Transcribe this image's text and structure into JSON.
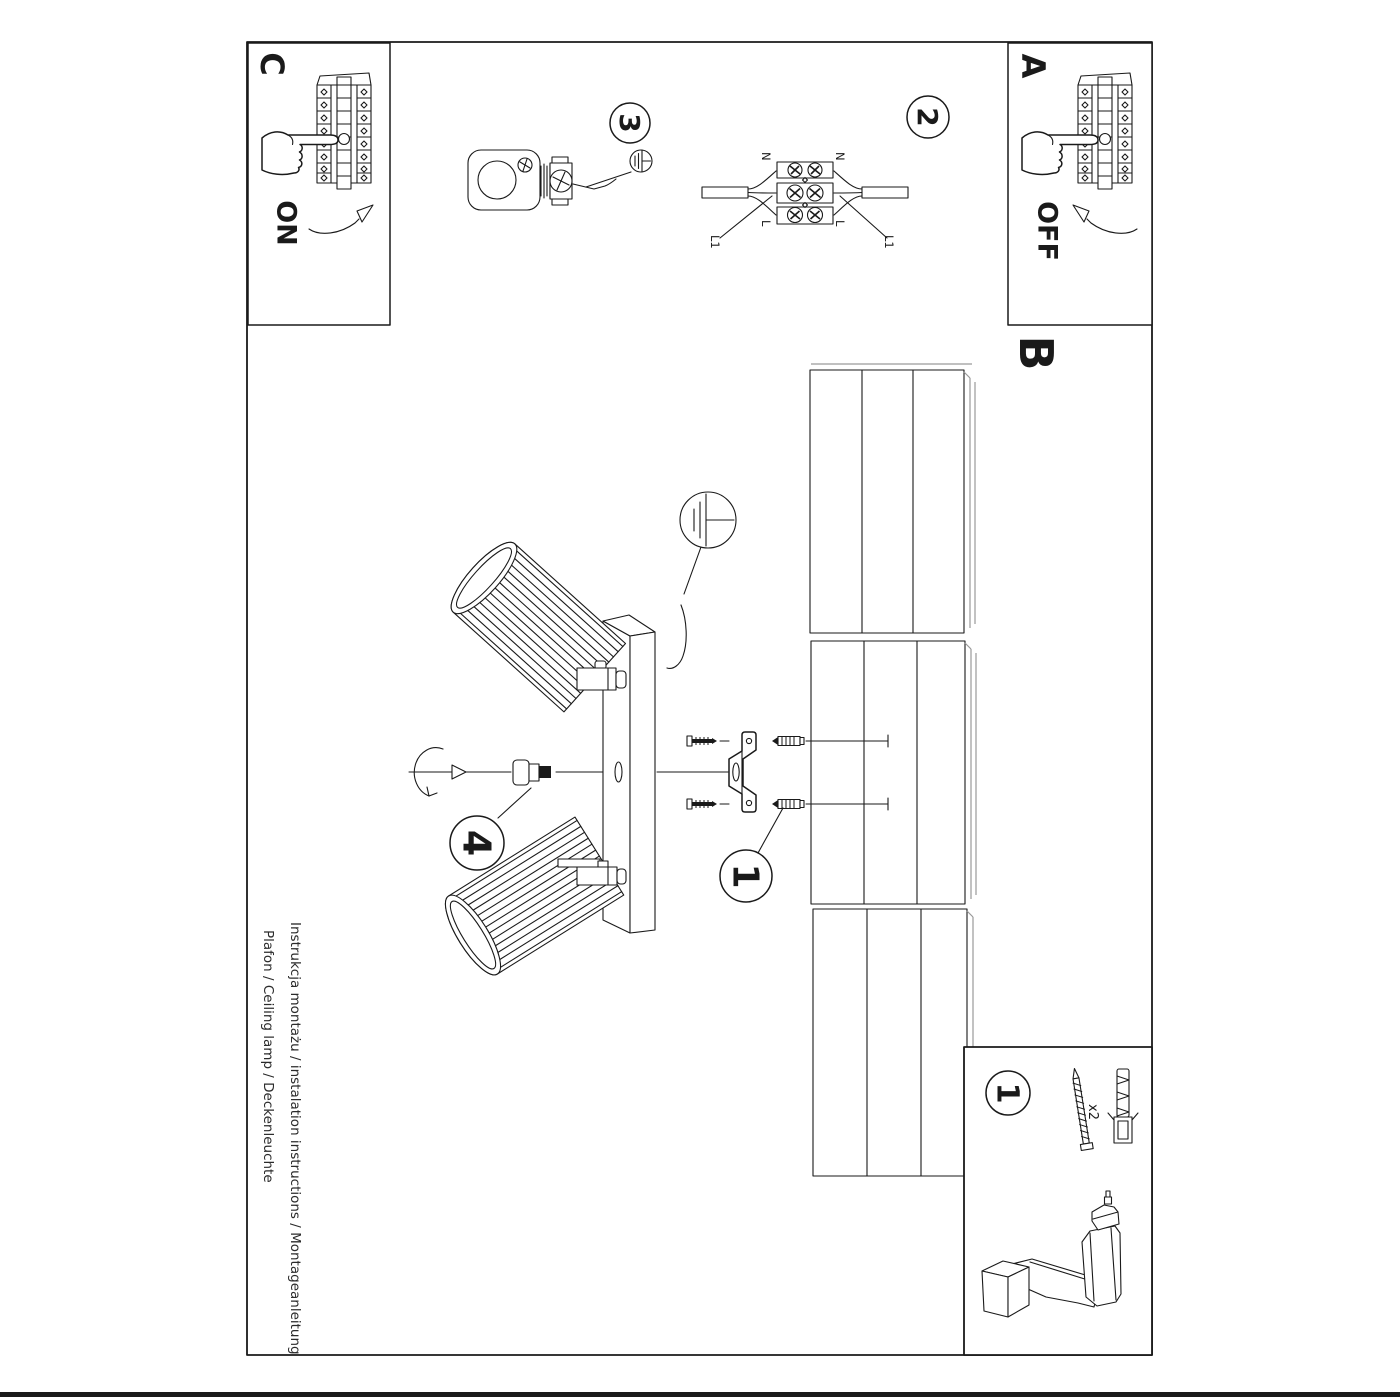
{
  "colors": {
    "ink": "#1a1a1a",
    "gray": "#9a9a9a",
    "background": "#ffffff"
  },
  "frame_letters": {
    "a": "A",
    "b": "B",
    "c": "C"
  },
  "switch_labels": {
    "on": "ON",
    "off": "OFF"
  },
  "step_numbers": {
    "step1": "1",
    "step2": "2",
    "step3": "3",
    "step4": "4"
  },
  "wiring_labels": {
    "n_left": "N",
    "n_right": "N",
    "l_left": "L",
    "l_right": "L",
    "l1_left": "L1",
    "l1_right": "L1"
  },
  "hardware": {
    "step": "1",
    "quantity": "x2"
  },
  "footer": {
    "line1": "Instrukcja montażu / instalation instructions / Montageanleitung",
    "line2": "Plafon / Ceiling lamp / Deckenleuchte"
  }
}
